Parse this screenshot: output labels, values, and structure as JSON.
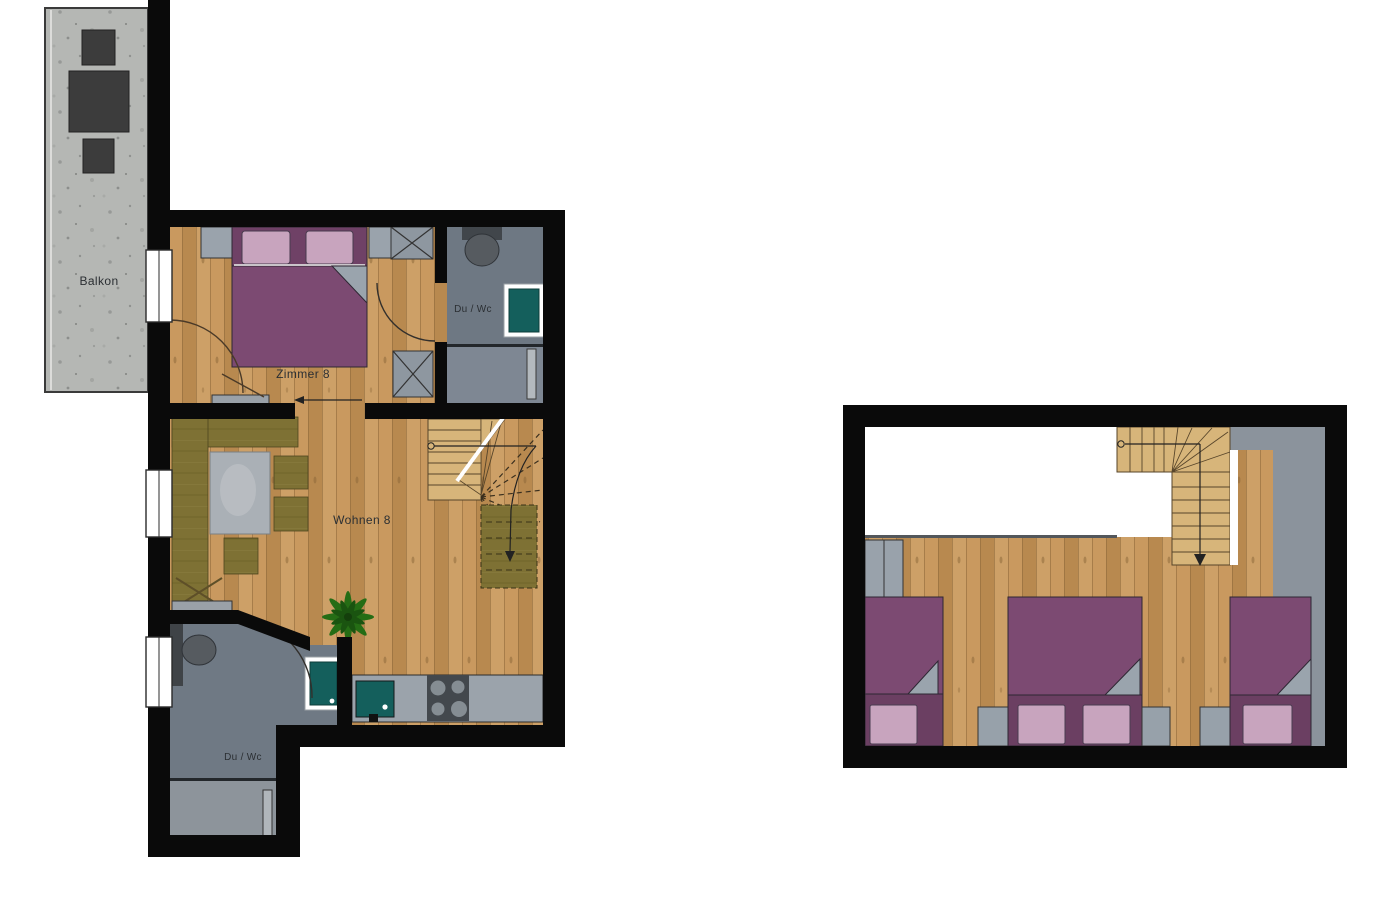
{
  "palette": {
    "background": "#ffffff",
    "wall": "#0a0a0a",
    "wood_floor": "#c2935a",
    "wood_stairs": "#d7b57a",
    "concrete": "#b5b7b4",
    "tile_dark": "#6e7883",
    "tile_mid": "#7e8793",
    "tile_light": "#8d949b",
    "sofa_olive": "#7e7134",
    "bed_purple": "#7c4a72",
    "bed_purple_dark": "#6b3f62",
    "pillow_pink": "#c8a4be",
    "shower_teal": "#145f5c",
    "furniture_gray": "#99a2ab",
    "furniture_dark": "#3c3c3c",
    "plant_green": "#256d15"
  },
  "ground_floor": {
    "balcony_label": "Balkon",
    "bedroom_label": "Zimmer 8",
    "bathroom_top_label": "Du / Wc",
    "living_label": "Wohnen 8",
    "bathroom_bottom_label": "Du / Wc"
  },
  "upper_floor": {
    "labels": []
  }
}
